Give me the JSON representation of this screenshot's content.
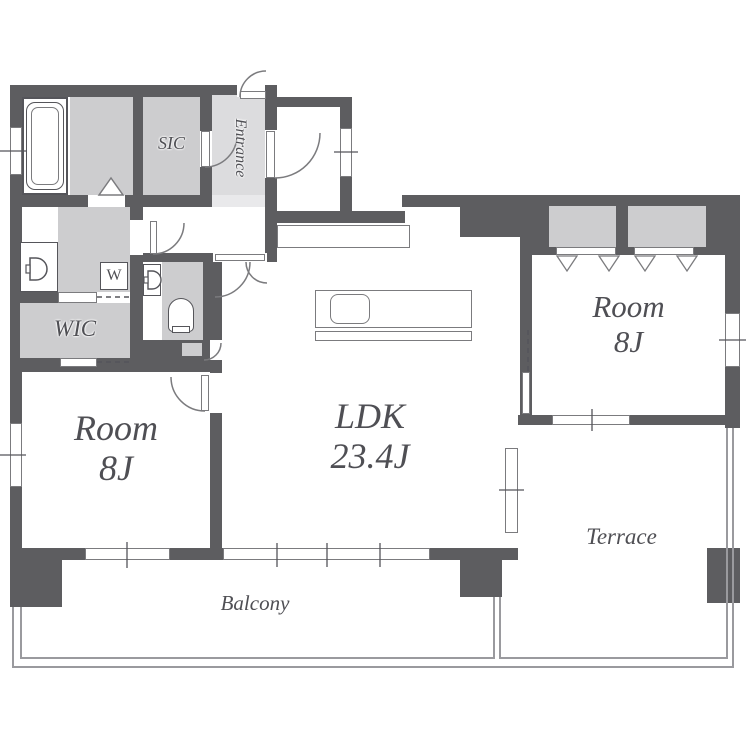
{
  "plan": {
    "entrance": "Entrance",
    "sic": "SIC",
    "wic": "WIC",
    "washing_machine": "W",
    "room_left": {
      "name": "Room",
      "size": "8J"
    },
    "room_right": {
      "name": "Room",
      "size": "8J"
    },
    "ldk": {
      "name": "LDK",
      "size": "23.4J"
    },
    "terrace": "Terrace",
    "balcony": "Balcony"
  },
  "colors": {
    "wall": "#5d5d60",
    "closet_fill": "#cdcdcf",
    "entrance_fill": "#dcdcde",
    "line": "#7b7b7e",
    "text": "#4f4f54"
  }
}
